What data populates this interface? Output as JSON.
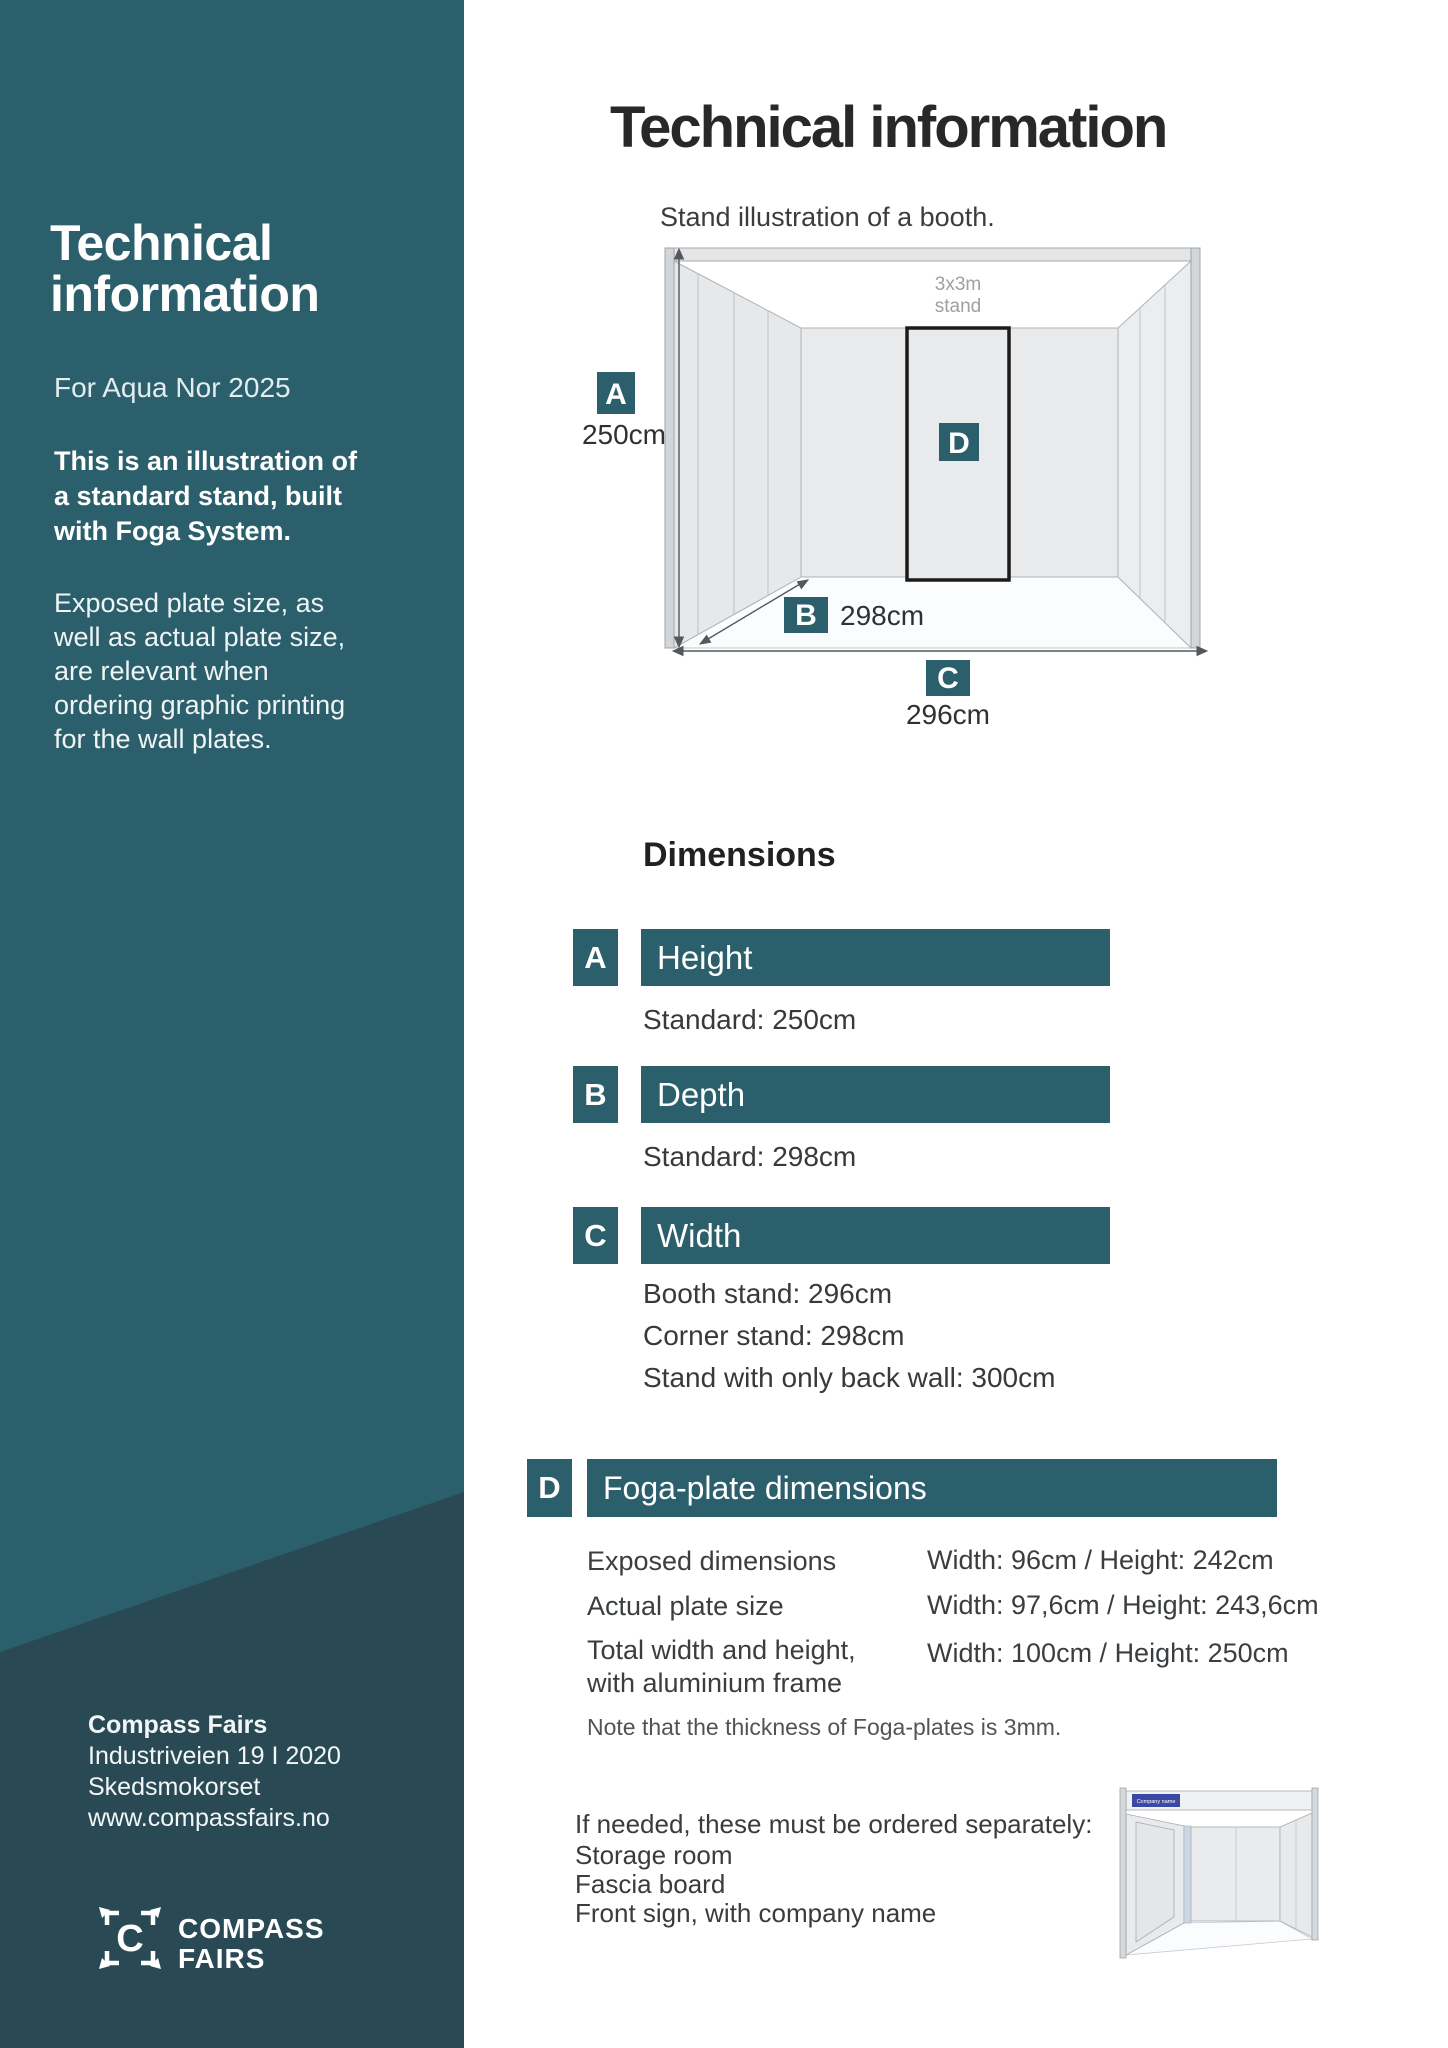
{
  "sidebar": {
    "heading_lines": [
      "Technical",
      "information"
    ],
    "subheading": "For Aqua Nor 2025",
    "intro_bold_lines": [
      "This is an illustration of",
      "a standard stand, built",
      "with Foga System."
    ],
    "intro_lines": [
      "Exposed plate size, as",
      "well as actual plate size,",
      "are relevant when",
      "ordering graphic printing",
      "for the wall plates."
    ],
    "address": {
      "company": "Compass Fairs",
      "street": "Industriveien 19 I 2020",
      "city": "Skedsmokorset",
      "website": "www.compassfairs.no"
    },
    "logo": {
      "letter": "C",
      "word1": "COMPASS",
      "word2": "FAIRS"
    }
  },
  "main": {
    "title": "Technical information",
    "illustration": {
      "caption": "Stand illustration of a booth.",
      "stand_label_line1": "3x3m",
      "stand_label_line2": "stand",
      "marker_a": "A",
      "marker_b": "B",
      "marker_c": "C",
      "marker_d": "D",
      "measure_a": "250cm",
      "measure_b": "298cm",
      "measure_c": "296cm"
    },
    "dimensions": {
      "heading": "Dimensions",
      "rows": [
        {
          "marker": "A",
          "title": "Height",
          "lines": [
            "Standard: 250cm"
          ]
        },
        {
          "marker": "B",
          "title": "Depth",
          "lines": [
            "Standard: 298cm"
          ]
        },
        {
          "marker": "C",
          "title": "Width",
          "lines": [
            "Booth stand: 296cm",
            "Corner stand: 298cm",
            "Stand with only back wall: 300cm"
          ]
        }
      ]
    },
    "foga": {
      "marker": "D",
      "title": "Foga-plate dimensions",
      "rows": [
        {
          "label1": "Exposed dimensions",
          "label2": "",
          "value": "Width: 96cm / Height: 242cm"
        },
        {
          "label1": "Actual plate size",
          "label2": "",
          "value": "Width: 97,6cm / Height: 243,6cm"
        },
        {
          "label1": "Total width and height,",
          "label2": "with aluminium frame",
          "value": "Width: 100cm / Height: 250cm"
        }
      ],
      "note": "Note that the thickness of Foga-plates is 3mm."
    },
    "order_info": {
      "intro": "If needed, these must be ordered separately:",
      "items": [
        "Storage room",
        "Fascia board",
        "Front sign, with company name"
      ]
    },
    "mini_booth": {
      "sign_text": "Company name"
    }
  },
  "colors": {
    "teal": "#2C5F6C",
    "teal_dark": "#294A55",
    "sign_blue": "#3A4AA2",
    "frame_black": "#1B1B1B"
  }
}
